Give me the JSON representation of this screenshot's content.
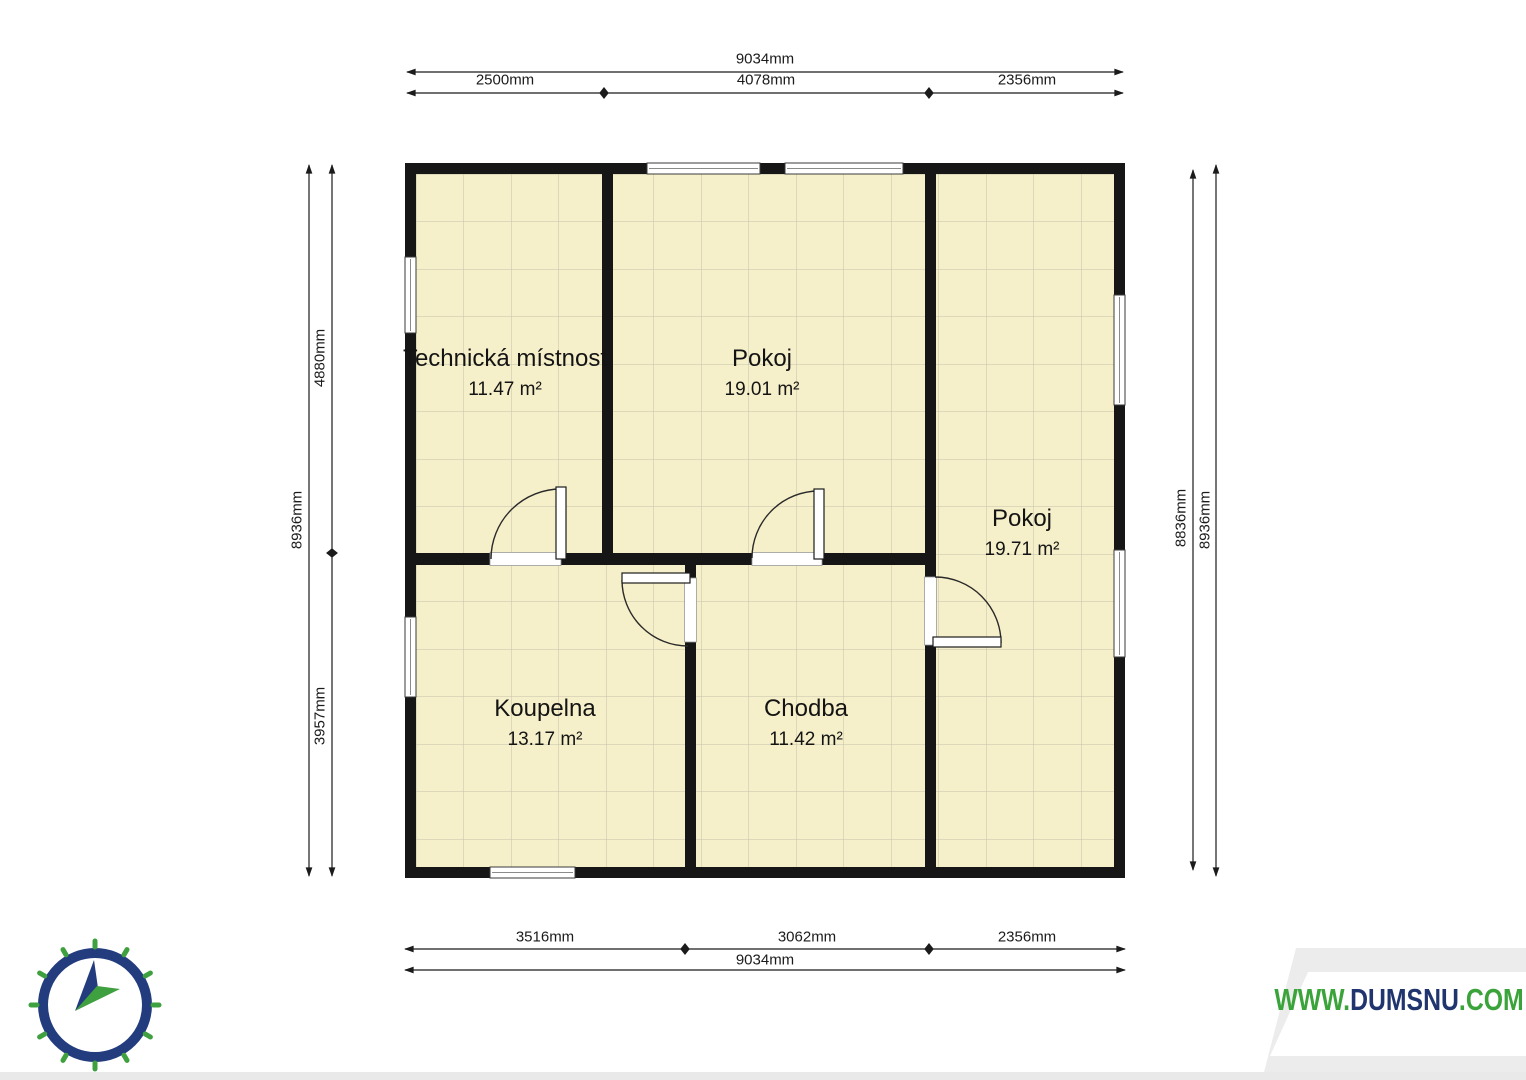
{
  "title": "Floor plan",
  "rooms": [
    {
      "name": "Technická místnost",
      "area": "11.47 m²"
    },
    {
      "name": "Pokoj",
      "area": "19.01 m²"
    },
    {
      "name": "Pokoj",
      "area": "19.71 m²"
    },
    {
      "name": "Koupelna",
      "area": "13.17 m²"
    },
    {
      "name": "Chodba",
      "area": "11.42 m²"
    }
  ],
  "dimensions": {
    "top_total": "9034mm",
    "top_segments": [
      "2500mm",
      "4078mm",
      "2356mm"
    ],
    "bottom_segments": [
      "3516mm",
      "3062mm",
      "2356mm"
    ],
    "bottom_total": "9034mm",
    "left_total": "8936mm",
    "left_segments": [
      "4880mm",
      "3957mm"
    ],
    "right_inner": "8836mm",
    "right_outer": "8936mm"
  },
  "watermark": {
    "prefix": "WWW.",
    "name": "DUMSNU",
    "suffix": ".COM"
  },
  "icons": {
    "compass": "compass-icon"
  },
  "colors": {
    "floor": "#f6f0ca",
    "grid": "#b5b19f",
    "wall": "#161616",
    "accent_green": "#3aa33a",
    "accent_navy": "#20356e"
  }
}
